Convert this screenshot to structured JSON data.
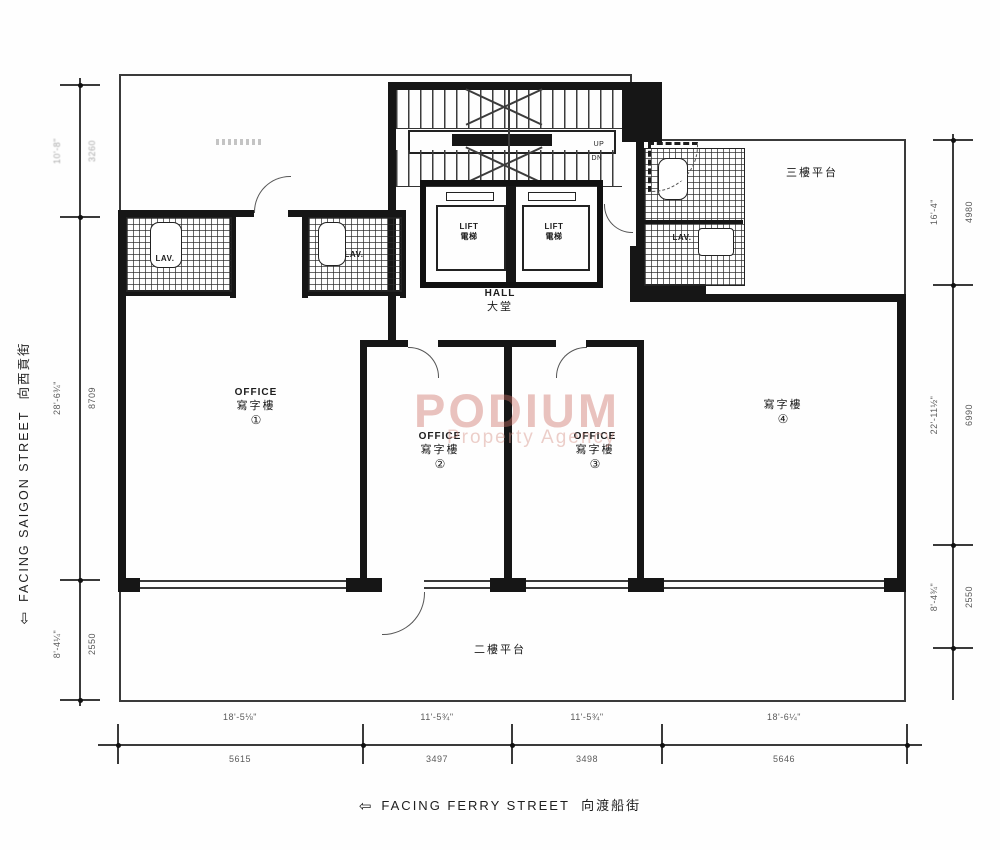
{
  "watermark": {
    "name": "PODIUM",
    "tagline": "Property Agency"
  },
  "streets": {
    "left": {
      "arrow": "⇦",
      "en": "FACING SAIGON STREET",
      "zh": "向西貢街"
    },
    "bottom": {
      "arrow": "⇦",
      "en": "FACING FERRY STREET",
      "zh": "向渡船街"
    }
  },
  "rooms": {
    "office1": {
      "en": "OFFICE",
      "zh": "寫字樓",
      "num": "①"
    },
    "office2": {
      "en": "OFFICE",
      "zh": "寫字樓",
      "num": "②"
    },
    "office3": {
      "en": "OFFICE",
      "zh": "寫字樓",
      "num": "③"
    },
    "office4": {
      "zh": "寫字樓",
      "num": "④"
    },
    "hall": {
      "en": "HALL",
      "zh": "大堂"
    },
    "lift": {
      "en": "LIFT",
      "zh": "電梯"
    },
    "lav": {
      "en": "LAV."
    },
    "terraceTopRight": {
      "zh": "三樓平台"
    },
    "terraceBottom": {
      "zh": "二樓平台"
    },
    "stairs": {
      "up": "UP",
      "dn": "DN"
    }
  },
  "dims": {
    "bottom": [
      {
        "ft": "18'-5⅛\"",
        "mm": "5615"
      },
      {
        "ft": "11'-5¾\"",
        "mm": "3497"
      },
      {
        "ft": "11'-5¾\"",
        "mm": "3498"
      },
      {
        "ft": "18'-6¼\"",
        "mm": "5646"
      }
    ],
    "left": [
      {
        "ft": "10'-8\"",
        "mm": "3260"
      },
      {
        "ft": "28'-6¾\"",
        "mm": "8709"
      },
      {
        "ft": "8'-4¼\"",
        "mm": "2550"
      }
    ],
    "right": [
      {
        "ft": "16'-4\"",
        "mm": "4980"
      },
      {
        "ft": "22'-11½\"",
        "mm": "6990"
      },
      {
        "ft": "8'-4¾\"",
        "mm": "2550"
      }
    ]
  },
  "colors": {
    "ink": "#161616",
    "watermark": "#cd7066"
  }
}
